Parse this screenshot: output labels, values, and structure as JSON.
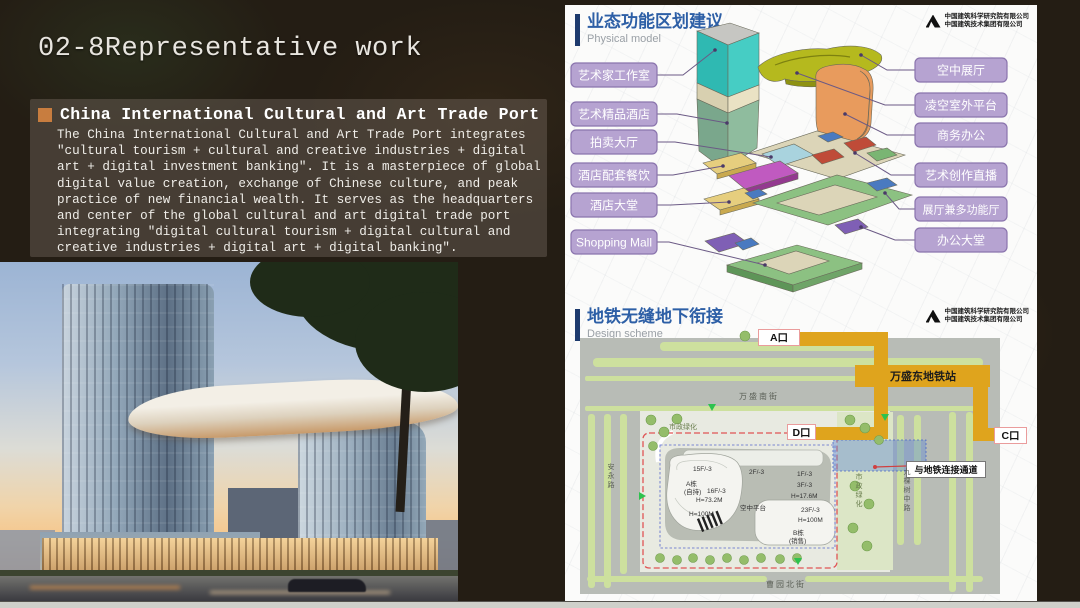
{
  "slide": {
    "title": "02-8Representative work",
    "section": {
      "heading": "China International Cultural and Art Trade Port",
      "body": "The China International Cultural and Art Trade Port integrates ″cultural tourism + cultural and creative industries + digital art + digital investment banking″. It is a masterpiece of global digital value creation, exchange of Chinese culture, and peak practice of new financial wealth. It serves as the headquarters and center of the global cultural and art digital trade port integrating ″digital cultural tourism + digital cultural and creative industries + digital art + digital banking″."
    }
  },
  "logo": {
    "line1": "中国建筑科学研究院有限公司",
    "line2": "中国建筑技术集团有限公司"
  },
  "panel_model": {
    "title": "业态功能区划建议",
    "subtitle": "Physical model",
    "labels_left": [
      "艺术家工作室",
      "艺术精品酒店",
      "拍卖大厅",
      "酒店配套餐饮",
      "酒店大堂",
      "Shopping Mall"
    ],
    "labels_right": [
      "空中展厅",
      "凌空室外平台",
      "商务办公",
      "艺术创作直播",
      "展厅兼多功能厅",
      "办公大堂"
    ]
  },
  "panel_metro": {
    "title": "地铁无缝地下衔接",
    "subtitle": "Design scheme",
    "station_label": "万盛东地铁站",
    "exit_a": "A口",
    "exit_c": "C口",
    "exit_d": "D口",
    "connection_label": "与地铁连接通道",
    "street_north": "万盛南街",
    "street_west": "安永路",
    "street_east": "九棵树中路",
    "street_south": "曹园北街",
    "green_label": "市政绿化",
    "annotations": {
      "a_floors": "15F/-3",
      "a_name": "A栋",
      "a_hold": "(自持)",
      "a_floors2": "16F/-3",
      "a_height": "H=73.2M",
      "a_height2": "H=100M",
      "platform": "空中平台",
      "p_2f": "2F/-3",
      "p_1f": "1F/-3",
      "p_3f": "3F/-3",
      "p_h": "H=17.6M",
      "b_floors": "23F/-3",
      "b_height": "H=100M",
      "b_name": "B栋",
      "b_sale": "(销售)"
    }
  },
  "colors": {
    "accent_orange": "#c87d3f",
    "header_blue": "#2d5fa6",
    "label_purple": "#b6a3d1",
    "metro_yellow": "#dfa41d"
  }
}
